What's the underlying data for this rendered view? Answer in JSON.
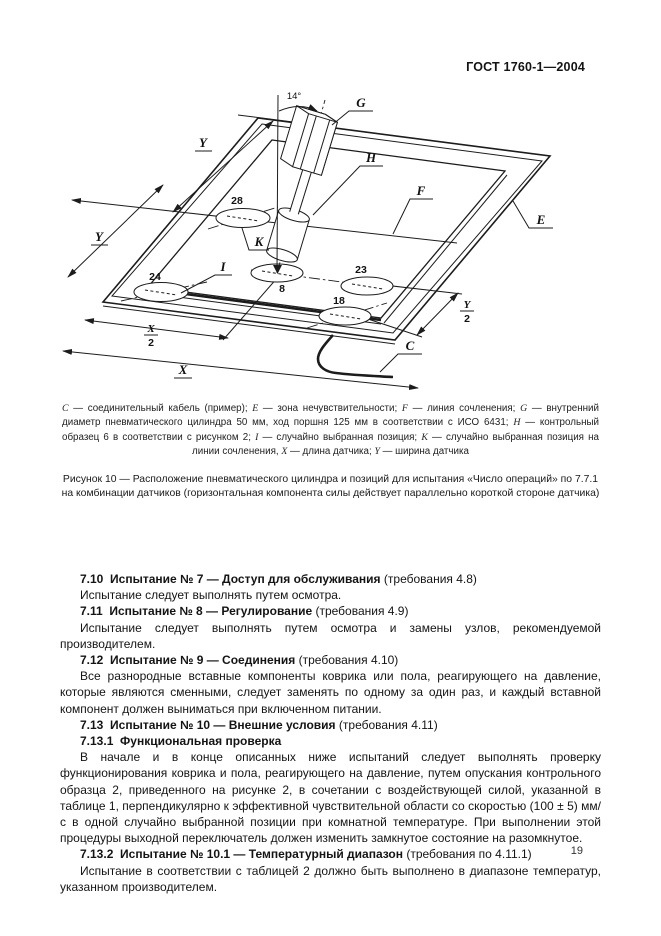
{
  "header": {
    "doc_code": "ГОСТ 1760-1—2004"
  },
  "figure": {
    "diagram_labels": {
      "angle": "14°",
      "g": "G",
      "h": "H",
      "f": "F",
      "e": "E",
      "c": "C",
      "k": "K",
      "i": "I",
      "dim_x": "X",
      "dim_y": "Y",
      "half": "2",
      "pos_28": "28",
      "pos_24": "24",
      "pos_8": "8",
      "pos_23": "23",
      "pos_18": "18"
    },
    "legend": [
      {
        "term": "C",
        "desc": "соединительный кабель (пример)",
        "sep": ";"
      },
      {
        "term": "E",
        "desc": "зона нечувствительности",
        "sep": ";"
      },
      {
        "term": "F",
        "desc": "линия сочленения",
        "sep": ";"
      },
      {
        "term": "G",
        "desc": "внутренний диаметр пневматического цилиндра 50 мм, ход поршня 125 мм в соответствии с ИСО 6431",
        "sep": ";"
      },
      {
        "term": "H",
        "desc": "контрольный образец 6 в соответствии с рисунком 2",
        "sep": ";"
      },
      {
        "term": "I",
        "desc": "случайно выбранная позиция",
        "sep": ";"
      },
      {
        "term": "K",
        "desc": "случайно выбранная позиция на линии сочленения",
        "sep": ","
      },
      {
        "term": "X",
        "desc": "длина датчика",
        "sep": ";"
      },
      {
        "term": "Y",
        "desc": "ширина датчика",
        "sep": ""
      }
    ],
    "caption": "Рисунок 10 — Расположение пневматического цилиндра и позиций для испытания «Число операций» по 7.7.1 на комбинации датчиков (горизонтальная компонента силы действует параллельно короткой стороне датчика)"
  },
  "body": {
    "blocks": [
      {
        "type": "heading",
        "bold": "7.10  Испытание № 7 — Доступ для обслуживания",
        "normal": " (требования 4.8)"
      },
      {
        "type": "para",
        "text": "Испытание следует выполнять путем осмотра."
      },
      {
        "type": "heading",
        "bold": "7.11  Испытание № 8 — Регулирование",
        "normal": " (требования 4.9)"
      },
      {
        "type": "para",
        "text": "Испытание следует выполнять путем осмотра и замены узлов, рекомендуемой производителем."
      },
      {
        "type": "heading",
        "bold": "7.12  Испытание № 9 — Соединения",
        "normal": " (требования 4.10)"
      },
      {
        "type": "para",
        "text": "Все разнородные вставные компоненты коврика или пола, реагирующего на давление, которые являются сменными, следует заменять по одному за один раз, и каждый вставной компонент должен выниматься при включенном питании."
      },
      {
        "type": "heading",
        "bold": "7.13  Испытание № 10 — Внешние условия",
        "normal": " (требования 4.11)"
      },
      {
        "type": "heading",
        "bold": "7.13.1  Функциональная проверка",
        "normal": ""
      },
      {
        "type": "para",
        "text": "В начале и в конце описанных ниже испытаний следует выполнять проверку функционирования коврика и пола, реагирующего на давление, путем опускания контрольного образца 2, приведенного на рисунке 2, в сочетании с воздействующей силой, указанной в таблице 1, перпендикулярно к эффективной чувствительной области со скоростью (100 ± 5) мм/с в одной случайно выбранной позиции при комнатной температуре. При выполнении этой процедуры выходной переключатель должен изменить замкнутое состояние на разомкнутое."
      },
      {
        "type": "heading",
        "bold": "7.13.2  Испытание № 10.1 — Температурный диапазон",
        "normal": " (требования по 4.11.1)"
      },
      {
        "type": "para",
        "text": "Испытание в соответствии с таблицей 2 должно быть выполнено в диапазоне температур, указанном производителем."
      }
    ]
  },
  "page": {
    "number": "19"
  }
}
